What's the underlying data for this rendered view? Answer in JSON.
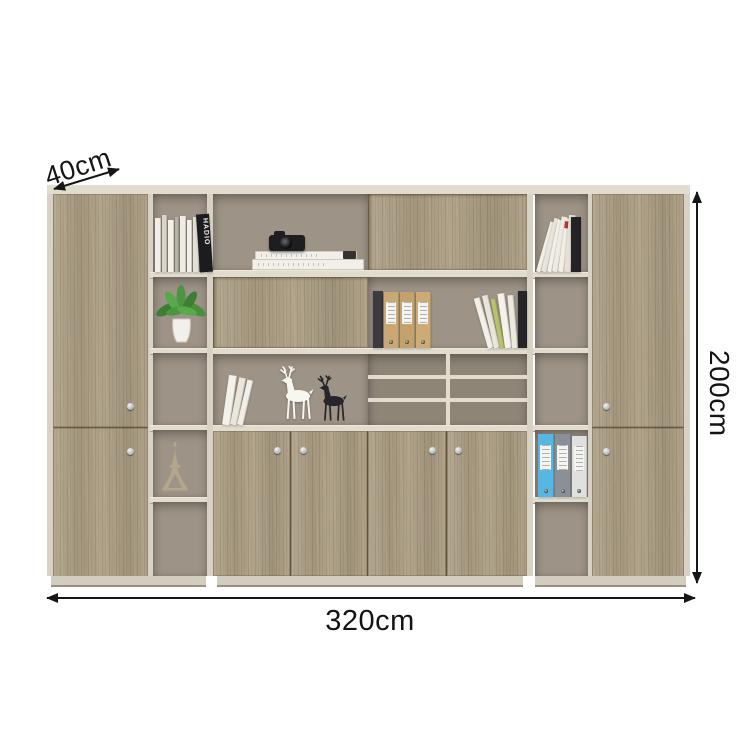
{
  "annotations": {
    "depth_label": "40cm",
    "height_label": "200cm",
    "width_label": "320cm"
  },
  "palette": {
    "wood": "#ab9d83",
    "frame": "#d8d2c5",
    "frame_light": "#e2dccf",
    "interior": "#9d9386",
    "interior_dark": "#8e8577",
    "plinth": "#d3cdc0",
    "annotation_color": "#161616",
    "binder_blue": "#56b7e3",
    "binder_gray": "#8a9097",
    "binder_white": "#dfe0e0",
    "binder_tan": "#c9a873",
    "plant_green": "#4c9440",
    "deer_white": "#f8f6f1",
    "deer_black": "#26262a",
    "eiffel_tan": "#b3a68a"
  },
  "visible_objects": [
    "books",
    "camera",
    "potted-plant",
    "eiffel-tower-model",
    "deer-figurines",
    "ring-binders",
    "spiral-notebook",
    "pigeonhole-trays"
  ],
  "decor": {
    "left_top_books": [
      {
        "w": 5,
        "h": 54,
        "c": "#f1eee7"
      },
      {
        "w": 4,
        "h": 57,
        "c": "#dad5cb"
      },
      {
        "w": 5,
        "h": 52,
        "c": "#f4f1ea"
      },
      {
        "w": 3,
        "h": 55,
        "c": "#b9b3a7"
      },
      {
        "w": 5,
        "h": 56,
        "c": "#efece4"
      },
      {
        "w": 4,
        "h": 52,
        "c": "#f3f0e9"
      },
      {
        "w": 5,
        "h": 55,
        "c": "#e3dfd5"
      },
      {
        "w": 12,
        "h": 58,
        "c": "#1c1c1f",
        "label": "HADIO",
        "tilt": -4
      }
    ],
    "right_top_books": [
      {
        "w": 4,
        "h": 52,
        "c": "#f2efe8",
        "tilt": 16
      },
      {
        "w": 5,
        "h": 55,
        "c": "#e8e4da",
        "tilt": 14
      },
      {
        "w": 4,
        "h": 53,
        "c": "#f4f1ea",
        "tilt": 12
      },
      {
        "w": 5,
        "h": 56,
        "c": "#efebe2",
        "tilt": 10
      },
      {
        "w": 5,
        "h": 54,
        "c": "#f2efe8",
        "tilt": 8,
        "band": "#b03a2e"
      },
      {
        "w": 6,
        "h": 57,
        "c": "#e5e1d7",
        "tilt": 5
      },
      {
        "w": 9,
        "h": 55,
        "c": "#232326"
      }
    ],
    "row2_files": [
      {
        "w": 9,
        "h": 57,
        "c": "#3b3b40",
        "spiral": true
      },
      {
        "w": 14,
        "h": 56,
        "c": "#c9a873",
        "lbl": true,
        "holes": true
      },
      {
        "w": 14,
        "h": 56,
        "c": "#c4a26c",
        "lbl": true,
        "holes": true
      },
      {
        "w": 14,
        "h": 56,
        "c": "#cdab75",
        "lbl": true,
        "holes": true
      }
    ],
    "row2_lean_books": [
      {
        "w": 5,
        "h": 52,
        "c": "#f3f0e9",
        "tilt": -16
      },
      {
        "w": 5,
        "h": 54,
        "c": "#e9e5db",
        "tilt": -13
      },
      {
        "w": 4,
        "h": 50,
        "c": "#b9c16b",
        "tilt": -11
      },
      {
        "w": 6,
        "h": 55,
        "c": "#f5f2ec",
        "tilt": -8
      },
      {
        "w": 5,
        "h": 53,
        "c": "#eceade",
        "tilt": -5
      },
      {
        "w": 8,
        "h": 57,
        "c": "#26262a"
      }
    ],
    "row3_books": [
      {
        "w": 7,
        "h": 50,
        "c": "#f4f1ea",
        "tilt": 8
      },
      {
        "w": 6,
        "h": 48,
        "c": "#eae6dc",
        "tilt": 11
      },
      {
        "w": 5,
        "h": 46,
        "c": "#f1eee7",
        "tilt": 13
      }
    ],
    "right_binders": [
      {
        "w": 15,
        "h": 63,
        "c": "#56b7e3",
        "lbl": true,
        "holes": true
      },
      {
        "w": 15,
        "h": 63,
        "c": "#8a9097",
        "lbl": true,
        "holes": true
      },
      {
        "w": 14,
        "h": 61,
        "c": "#dfe0e0",
        "lbl": true,
        "holes": true
      }
    ]
  }
}
